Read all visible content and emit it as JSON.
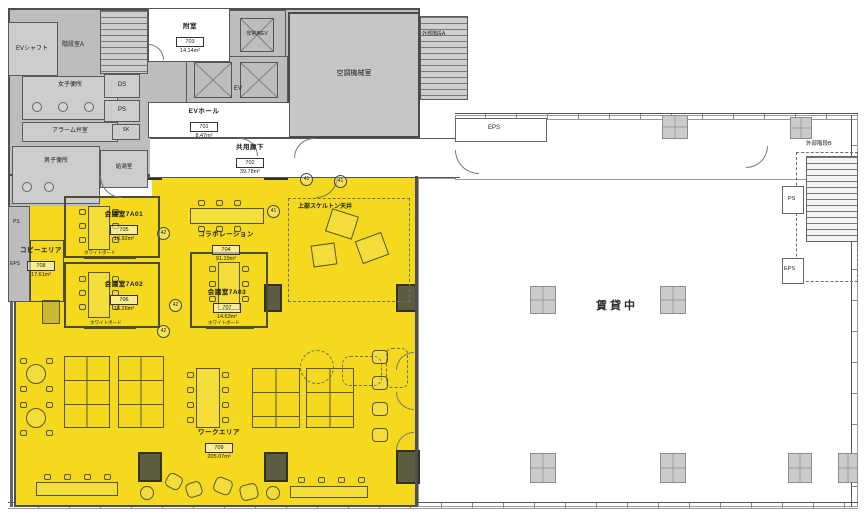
{
  "colors": {
    "highlight": "#F4D91E",
    "core_fill": "#BDBDBD",
    "sub_room_fill": "#CDCDCD",
    "wall": "#4F4F4F"
  },
  "core": {
    "ev_shaft": "EVシャフト",
    "stair_a": "階段室A",
    "womens_toilet": "女子便所",
    "alarm_valve": "アラーム弁室",
    "mens_toilet": "男子便所",
    "ds": "DS",
    "ps": "PS",
    "sk": "SK",
    "kitchenette": "給湯室",
    "emergency_ev": "非常用EV",
    "ev": "EV",
    "hvac": "空調機械室",
    "ext_stair_a": "外部階段A",
    "eps_hall": "EPS",
    "ps_left": "PS",
    "eps_left": "EPS",
    "ext_stair_b": "外部階段B",
    "ps_right": "PS",
    "eps_right": "EPS"
  },
  "rooms": [
    {
      "name": "附室",
      "number": "703",
      "area": "14.14m²"
    },
    {
      "name": "EVホール",
      "number": "701",
      "area": "8.47m²"
    },
    {
      "name": "共用廊下",
      "number": "702",
      "area": "39.78m²"
    },
    {
      "name": "会議室7A01",
      "number": "705",
      "area": "16.92m²"
    },
    {
      "name": "会議室7A02",
      "number": "706",
      "area": "16.26m²"
    },
    {
      "name": "会議室7A03",
      "number": "707",
      "area": "14.63m²"
    },
    {
      "name": "コラボレーション",
      "number": "704",
      "area": "91.19m²"
    },
    {
      "name": "コピーエリア",
      "number": "708",
      "area": "17.61m²"
    },
    {
      "name": "ワークエリア",
      "number": "709",
      "area": "205.07m²"
    }
  ],
  "annot": {
    "leased": "賃貸中",
    "skeleton": "上部スケルトン天井",
    "whiteboard": "ホワイトボード",
    "k41": "41",
    "k42": "42"
  }
}
